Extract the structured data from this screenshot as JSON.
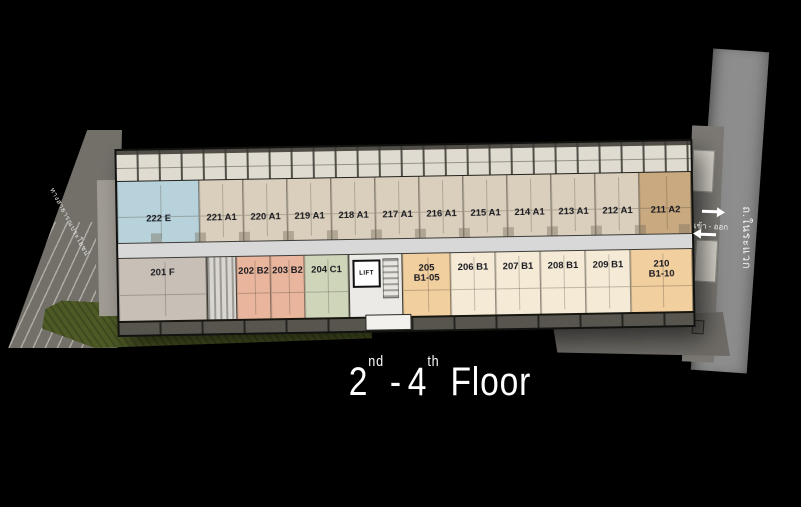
{
  "title": {
    "range_start": "2",
    "range_start_sup": "nd",
    "dash": "-",
    "range_end": "4",
    "range_end_sup": "th",
    "floor_word": "Floor"
  },
  "building": {
    "lift_label": "LIFT",
    "top_row": [
      {
        "label": "222 E",
        "type": "E"
      },
      {
        "label": "221 A1",
        "type": "A1"
      },
      {
        "label": "220 A1",
        "type": "A1"
      },
      {
        "label": "219 A1",
        "type": "A1"
      },
      {
        "label": "218 A1",
        "type": "A1"
      },
      {
        "label": "217 A1",
        "type": "A1"
      },
      {
        "label": "216 A1",
        "type": "A1"
      },
      {
        "label": "215 A1",
        "type": "A1"
      },
      {
        "label": "214 A1",
        "type": "A1"
      },
      {
        "label": "213 A1",
        "type": "A1"
      },
      {
        "label": "212 A1",
        "type": "A1"
      },
      {
        "label": "211 A2",
        "type": "A2"
      }
    ],
    "bottom_row": [
      {
        "label": "201 F",
        "type": "F"
      },
      {
        "label": "202 B2",
        "type": "B2"
      },
      {
        "label": "203 B2",
        "type": "B2"
      },
      {
        "label": "204 C1",
        "type": "C1"
      },
      {
        "label": "205",
        "label2": "B1-05",
        "type": "B1h"
      },
      {
        "label": "206 B1",
        "type": "B1"
      },
      {
        "label": "207 B1",
        "type": "B1"
      },
      {
        "label": "208 B1",
        "type": "B1"
      },
      {
        "label": "209 B1",
        "type": "B1"
      },
      {
        "label": "210",
        "label2": "B1-10",
        "type": "B1h"
      }
    ]
  },
  "roads": {
    "right_road_name": "ถ.ในระแวก",
    "entry_exit_label": "เข้า - ออก",
    "left_path_label": "ทางสาธารณประโยชน์"
  },
  "colors": {
    "background": "#000000",
    "title_text": "#ffffff",
    "unit_E": "#b7d2da",
    "unit_A1": "#d9cfbc",
    "unit_A2": "#c9a97f",
    "unit_F": "#c8c0b6",
    "unit_B2": "#e9b59c",
    "unit_C1": "#cfd5b9",
    "unit_B1": "#f4ead6",
    "unit_B1h": "#f2cf9e",
    "corridor": "#d8d8d8",
    "balcony": "#dfdbd0",
    "south_balcony": "#57554e",
    "lobby": "#eceae6",
    "grass": "#4d5a25",
    "road": "#8d8d8d",
    "lane": "#7b7873",
    "left_road": "#73706a",
    "apron": "#6e6b66",
    "stall": "#d6d3c9",
    "annex": "#a09c94"
  }
}
